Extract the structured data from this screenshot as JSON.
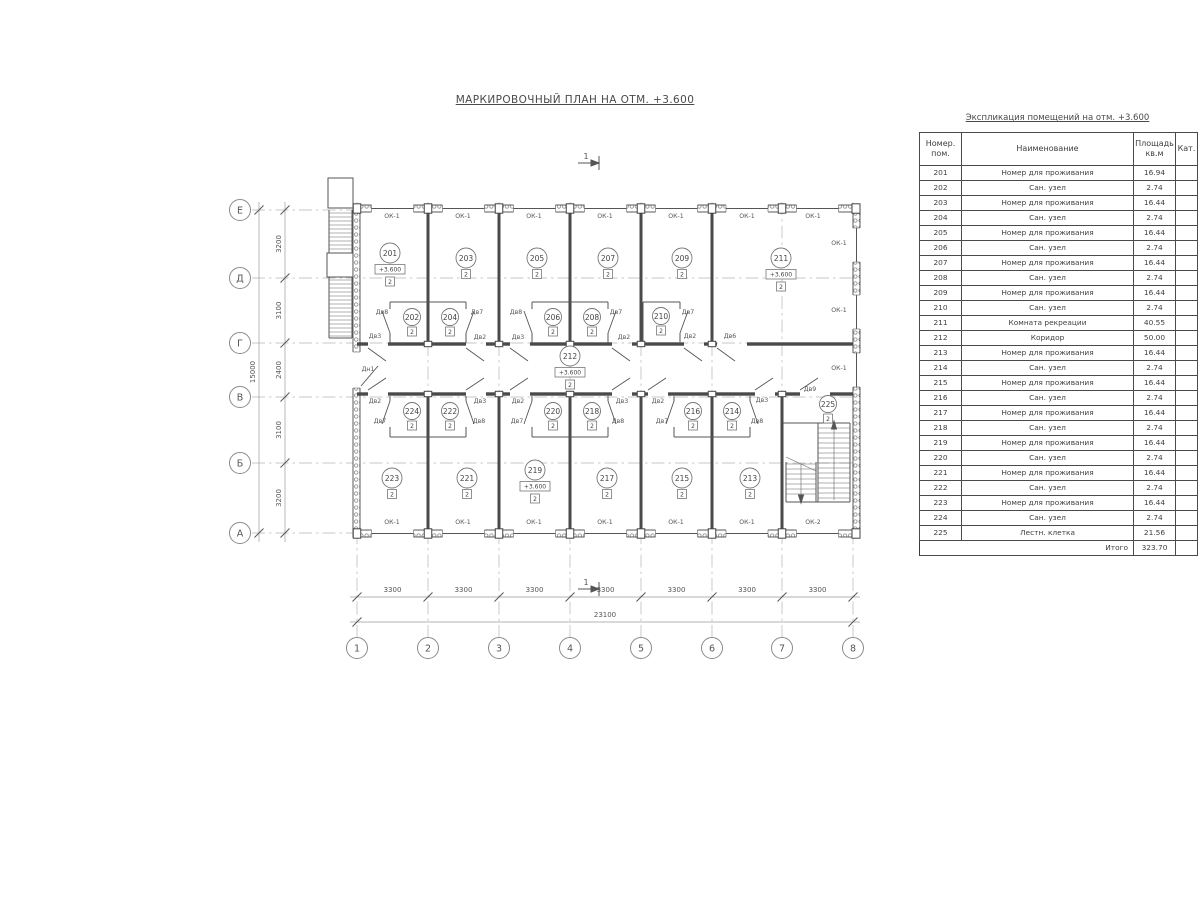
{
  "title": "МАРКИРОВОЧНЫЙ ПЛАН НА ОТМ. +3.600",
  "section_mark": "1",
  "level_label": "+3.600",
  "table": {
    "title": "Экспликация помещений на отм. +3.600",
    "headers": [
      "Номер.\nпом.",
      "Наименование",
      "Площадь\nкв.м",
      "Кат."
    ],
    "rows": [
      [
        "201",
        "Номер для проживания",
        "16.94",
        ""
      ],
      [
        "202",
        "Сан. узел",
        "2.74",
        ""
      ],
      [
        "203",
        "Номер для проживания",
        "16.44",
        ""
      ],
      [
        "204",
        "Сан. узел",
        "2.74",
        ""
      ],
      [
        "205",
        "Номер для проживания",
        "16.44",
        ""
      ],
      [
        "206",
        "Сан. узел",
        "2.74",
        ""
      ],
      [
        "207",
        "Номер для проживания",
        "16.44",
        ""
      ],
      [
        "208",
        "Сан. узел",
        "2.74",
        ""
      ],
      [
        "209",
        "Номер для проживания",
        "16.44",
        ""
      ],
      [
        "210",
        "Сан. узел",
        "2.74",
        ""
      ],
      [
        "211",
        "Комната рекреации",
        "40.55",
        ""
      ],
      [
        "212",
        "Коридор",
        "50.00",
        ""
      ],
      [
        "213",
        "Номер для проживания",
        "16.44",
        ""
      ],
      [
        "214",
        "Сан. узел",
        "2.74",
        ""
      ],
      [
        "215",
        "Номер для проживания",
        "16.44",
        ""
      ],
      [
        "216",
        "Сан. узел",
        "2.74",
        ""
      ],
      [
        "217",
        "Номер для проживания",
        "16.44",
        ""
      ],
      [
        "218",
        "Сан. узел",
        "2.74",
        ""
      ],
      [
        "219",
        "Номер для проживания",
        "16.44",
        ""
      ],
      [
        "220",
        "Сан. узел",
        "2.74",
        ""
      ],
      [
        "221",
        "Номер для проживания",
        "16.44",
        ""
      ],
      [
        "222",
        "Сан. узел",
        "2.74",
        ""
      ],
      [
        "223",
        "Номер для проживания",
        "16.44",
        ""
      ],
      [
        "224",
        "Сан. узел",
        "2.74",
        ""
      ],
      [
        "225",
        "Лестн. клетка",
        "21.56",
        ""
      ]
    ],
    "total_label": "Итого",
    "total_value": "323.70"
  },
  "plan": {
    "row_axes": [
      {
        "label": "Е",
        "y": 210
      },
      {
        "label": "Д",
        "y": 278
      },
      {
        "label": "Г",
        "y": 343
      },
      {
        "label": "В",
        "y": 397
      },
      {
        "label": "Б",
        "y": 463
      },
      {
        "label": "А",
        "y": 533
      }
    ],
    "col_axes": [
      {
        "label": "1",
        "x": 357
      },
      {
        "label": "2",
        "x": 428
      },
      {
        "label": "3",
        "x": 499
      },
      {
        "label": "4",
        "x": 570
      },
      {
        "label": "5",
        "x": 641
      },
      {
        "label": "6",
        "x": 712
      },
      {
        "label": "7",
        "x": 782
      },
      {
        "label": "8",
        "x": 853
      }
    ],
    "dims_left": {
      "values": [
        "3200",
        "3100",
        "2400",
        "3100",
        "3200"
      ],
      "total": "15000"
    },
    "dims_bottom": {
      "values": [
        "3300",
        "3300",
        "3300",
        "3300",
        "3300",
        "3300",
        "3300"
      ],
      "total": "23100"
    },
    "room_marks": [
      {
        "num": "201",
        "x": 390,
        "y": 253,
        "level": true
      },
      {
        "num": "203",
        "x": 466,
        "y": 258
      },
      {
        "num": "205",
        "x": 537,
        "y": 258
      },
      {
        "num": "207",
        "x": 608,
        "y": 258
      },
      {
        "num": "209",
        "x": 682,
        "y": 258
      },
      {
        "num": "211",
        "x": 781,
        "y": 258,
        "level": true
      },
      {
        "num": "202",
        "x": 412,
        "y": 317,
        "small": true
      },
      {
        "num": "204",
        "x": 450,
        "y": 317,
        "small": true
      },
      {
        "num": "206",
        "x": 553,
        "y": 317,
        "small": true
      },
      {
        "num": "208",
        "x": 592,
        "y": 317,
        "small": true
      },
      {
        "num": "210",
        "x": 661,
        "y": 316,
        "small": true
      },
      {
        "num": "212",
        "x": 570,
        "y": 356,
        "level": true,
        "corridor": true
      },
      {
        "num": "224",
        "x": 412,
        "y": 411,
        "small": true
      },
      {
        "num": "222",
        "x": 450,
        "y": 411,
        "small": true
      },
      {
        "num": "220",
        "x": 553,
        "y": 411,
        "small": true
      },
      {
        "num": "218",
        "x": 592,
        "y": 411,
        "small": true
      },
      {
        "num": "216",
        "x": 693,
        "y": 411,
        "small": true
      },
      {
        "num": "214",
        "x": 732,
        "y": 411,
        "small": true
      },
      {
        "num": "223",
        "x": 392,
        "y": 478
      },
      {
        "num": "221",
        "x": 467,
        "y": 478
      },
      {
        "num": "219",
        "x": 535,
        "y": 470,
        "level": true
      },
      {
        "num": "217",
        "x": 607,
        "y": 478
      },
      {
        "num": "215",
        "x": 682,
        "y": 478
      },
      {
        "num": "213",
        "x": 750,
        "y": 478
      },
      {
        "num": "225",
        "x": 828,
        "y": 404,
        "small": true
      }
    ],
    "door_labels": [
      {
        "t": "Дв8",
        "x": 382,
        "y": 314
      },
      {
        "t": "Дв7",
        "x": 477,
        "y": 314
      },
      {
        "t": "Дв8",
        "x": 516,
        "y": 314
      },
      {
        "t": "Дв7",
        "x": 616,
        "y": 314
      },
      {
        "t": "Дв7",
        "x": 688,
        "y": 314
      },
      {
        "t": "Дв3",
        "x": 375,
        "y": 338
      },
      {
        "t": "Дв2",
        "x": 480,
        "y": 339
      },
      {
        "t": "Дв3",
        "x": 518,
        "y": 339
      },
      {
        "t": "Дв2",
        "x": 624,
        "y": 339
      },
      {
        "t": "Дв2",
        "x": 690,
        "y": 338
      },
      {
        "t": "Дв6",
        "x": 730,
        "y": 338
      },
      {
        "t": "Дн1",
        "x": 368,
        "y": 371
      },
      {
        "t": "Дв2",
        "x": 375,
        "y": 403
      },
      {
        "t": "Дв3",
        "x": 480,
        "y": 403
      },
      {
        "t": "Дв2",
        "x": 518,
        "y": 403
      },
      {
        "t": "Дв3",
        "x": 622,
        "y": 403
      },
      {
        "t": "Дв2",
        "x": 658,
        "y": 403
      },
      {
        "t": "Дв3",
        "x": 762,
        "y": 402
      },
      {
        "t": "Дв9",
        "x": 810,
        "y": 391
      },
      {
        "t": "Дв7",
        "x": 380,
        "y": 423
      },
      {
        "t": "Дв8",
        "x": 479,
        "y": 423
      },
      {
        "t": "Дв7",
        "x": 517,
        "y": 423
      },
      {
        "t": "Дв8",
        "x": 618,
        "y": 423
      },
      {
        "t": "Дв7",
        "x": 662,
        "y": 423
      },
      {
        "t": "Дв8",
        "x": 757,
        "y": 423
      }
    ],
    "window_labels": [
      {
        "t": "ОК-1",
        "x": 392,
        "y": 218
      },
      {
        "t": "ОК-1",
        "x": 463,
        "y": 218
      },
      {
        "t": "ОК-1",
        "x": 534,
        "y": 218
      },
      {
        "t": "ОК-1",
        "x": 605,
        "y": 218
      },
      {
        "t": "ОК-1",
        "x": 676,
        "y": 218
      },
      {
        "t": "ОК-1",
        "x": 747,
        "y": 218
      },
      {
        "t": "ОК-1",
        "x": 813,
        "y": 218
      },
      {
        "t": "ОК-1",
        "x": 839,
        "y": 245
      },
      {
        "t": "ОК-1",
        "x": 839,
        "y": 312
      },
      {
        "t": "ОК-1",
        "x": 839,
        "y": 370
      },
      {
        "t": "ОК-1",
        "x": 392,
        "y": 524
      },
      {
        "t": "ОК-1",
        "x": 463,
        "y": 524
      },
      {
        "t": "ОК-1",
        "x": 534,
        "y": 524
      },
      {
        "t": "ОК-1",
        "x": 605,
        "y": 524
      },
      {
        "t": "ОК-1",
        "x": 676,
        "y": 524
      },
      {
        "t": "ОК-1",
        "x": 747,
        "y": 524
      },
      {
        "t": "ОК-2",
        "x": 813,
        "y": 524
      }
    ]
  }
}
